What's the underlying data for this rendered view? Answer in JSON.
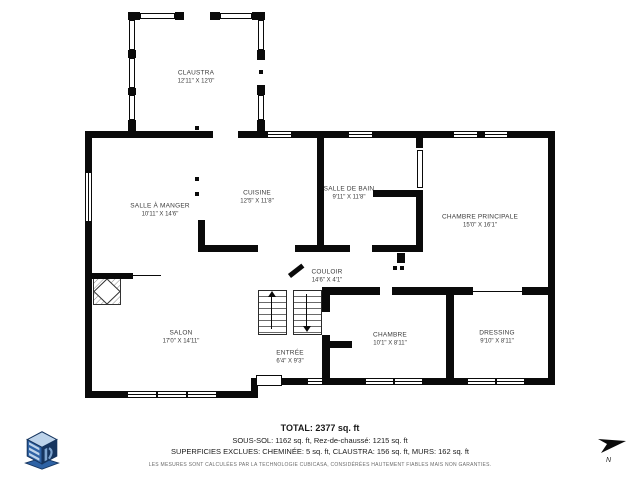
{
  "plan": {
    "rooms": [
      {
        "id": "claustra",
        "name": "CLAUSTRA",
        "dims": "12'11\" X 12'0\""
      },
      {
        "id": "salle-a-manger",
        "name": "SALLE À MANGER",
        "dims": "10'11\" X 14'6\""
      },
      {
        "id": "cuisine",
        "name": "CUISINE",
        "dims": "12'5\" X 11'8\""
      },
      {
        "id": "salle-de-bain",
        "name": "SALLE DE BAIN",
        "dims": "9'11\" X 11'8\""
      },
      {
        "id": "chambre-principale",
        "name": "CHAMBRE PRINCIPALE",
        "dims": "15'0\" X 16'1\""
      },
      {
        "id": "couloir",
        "name": "COULOIR",
        "dims": "14'6\" X 4'1\""
      },
      {
        "id": "salon",
        "name": "SALON",
        "dims": "17'0\" X 14'11\""
      },
      {
        "id": "entree",
        "name": "ENTRÉE",
        "dims": "6'4\" X 9'3\""
      },
      {
        "id": "chambre",
        "name": "CHAMBRE",
        "dims": "10'1\" X 8'11\""
      },
      {
        "id": "dressing",
        "name": "DRESSING",
        "dims": "9'10\" X 8'11\""
      }
    ]
  },
  "summary": {
    "total": "TOTAL: 2377 sq. ft",
    "levels": "SOUS-SOL: 1162 sq. ft, Rez-de-chaussé: 1215 sq. ft",
    "excluded": "SUPERFICIES EXCLUES: CHEMINÉE: 5 sq. ft, CLAUSTRA: 156 sq. ft, MURS: 162 sq. ft",
    "disclaimer": "LES MESURES SONT CALCULÉES PAR LA TECHNOLOGIE CUBICASA, CONSIDÉRÉES HAUTEMENT FIABLES MAIS NON GARANTIES."
  },
  "compass": {
    "label": "N"
  },
  "colors": {
    "wall": "#0a0a0a",
    "label_text": "#3b3b3b",
    "logo_dark": "#16355f",
    "logo_mid": "#2e62a4",
    "logo_light": "#bdd3ea"
  }
}
